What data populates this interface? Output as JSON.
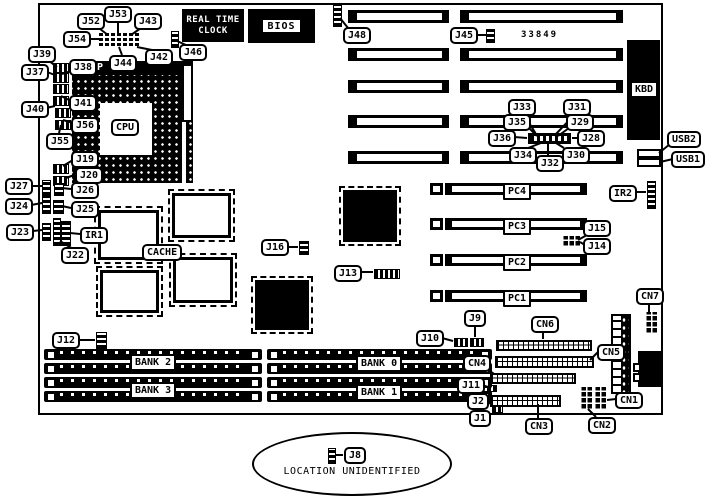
{
  "diagram": {
    "type": "motherboard-jumper-location-diagram",
    "board": {
      "cpu": "CPU",
      "socket_mark": "P",
      "cache": "CACHE",
      "rtc": [
        "REAL TIME",
        "CLOCK"
      ],
      "bios": "BIOS",
      "kbd": "KBD",
      "part_number": "33849"
    },
    "pci_slots": [
      "PC4",
      "PC3",
      "PC2",
      "PC1"
    ],
    "memory_banks": {
      "bank2": "BANK 2",
      "bank3": "BANK 3",
      "bank0": "BANK 0",
      "bank1": "BANK 1"
    },
    "callouts": {
      "j52": "J52",
      "j53": "J53",
      "j43": "J43",
      "j54": "J54",
      "j44": "J44",
      "j42": "J42",
      "j46": "J46",
      "j39": "J39",
      "j37": "J37",
      "j38": "J38",
      "j41": "J41",
      "j40": "J40",
      "j56": "J56",
      "j55": "J55",
      "j19": "J19",
      "j20": "J20",
      "j27": "J27",
      "j26": "J26",
      "j24": "J24",
      "j25": "J25",
      "j23": "J23",
      "ir1": "IR1",
      "j22": "J22",
      "j16": "J16",
      "j13": "J13",
      "j48": "J48",
      "j45": "J45",
      "j33": "J33",
      "j31": "J31",
      "j35": "J35",
      "j29": "J29",
      "j36": "J36",
      "j28": "J28",
      "j34": "J34",
      "j30": "J30",
      "j32": "J32",
      "usb2": "USB2",
      "usb1": "USB1",
      "ir2": "IR2",
      "j15": "J15",
      "j14": "J14",
      "cn7": "CN7",
      "j12": "J12",
      "j9": "J9",
      "j10": "J10",
      "cn6": "CN6",
      "cn5": "CN5",
      "cn4": "CN4",
      "j11": "J11",
      "j2": "J2",
      "j1": "J1",
      "cn3": "CN3",
      "cn2": "CN2",
      "cn1": "CN1",
      "j8": "J8"
    },
    "note": "LOCATION UNIDENTIFIED"
  }
}
